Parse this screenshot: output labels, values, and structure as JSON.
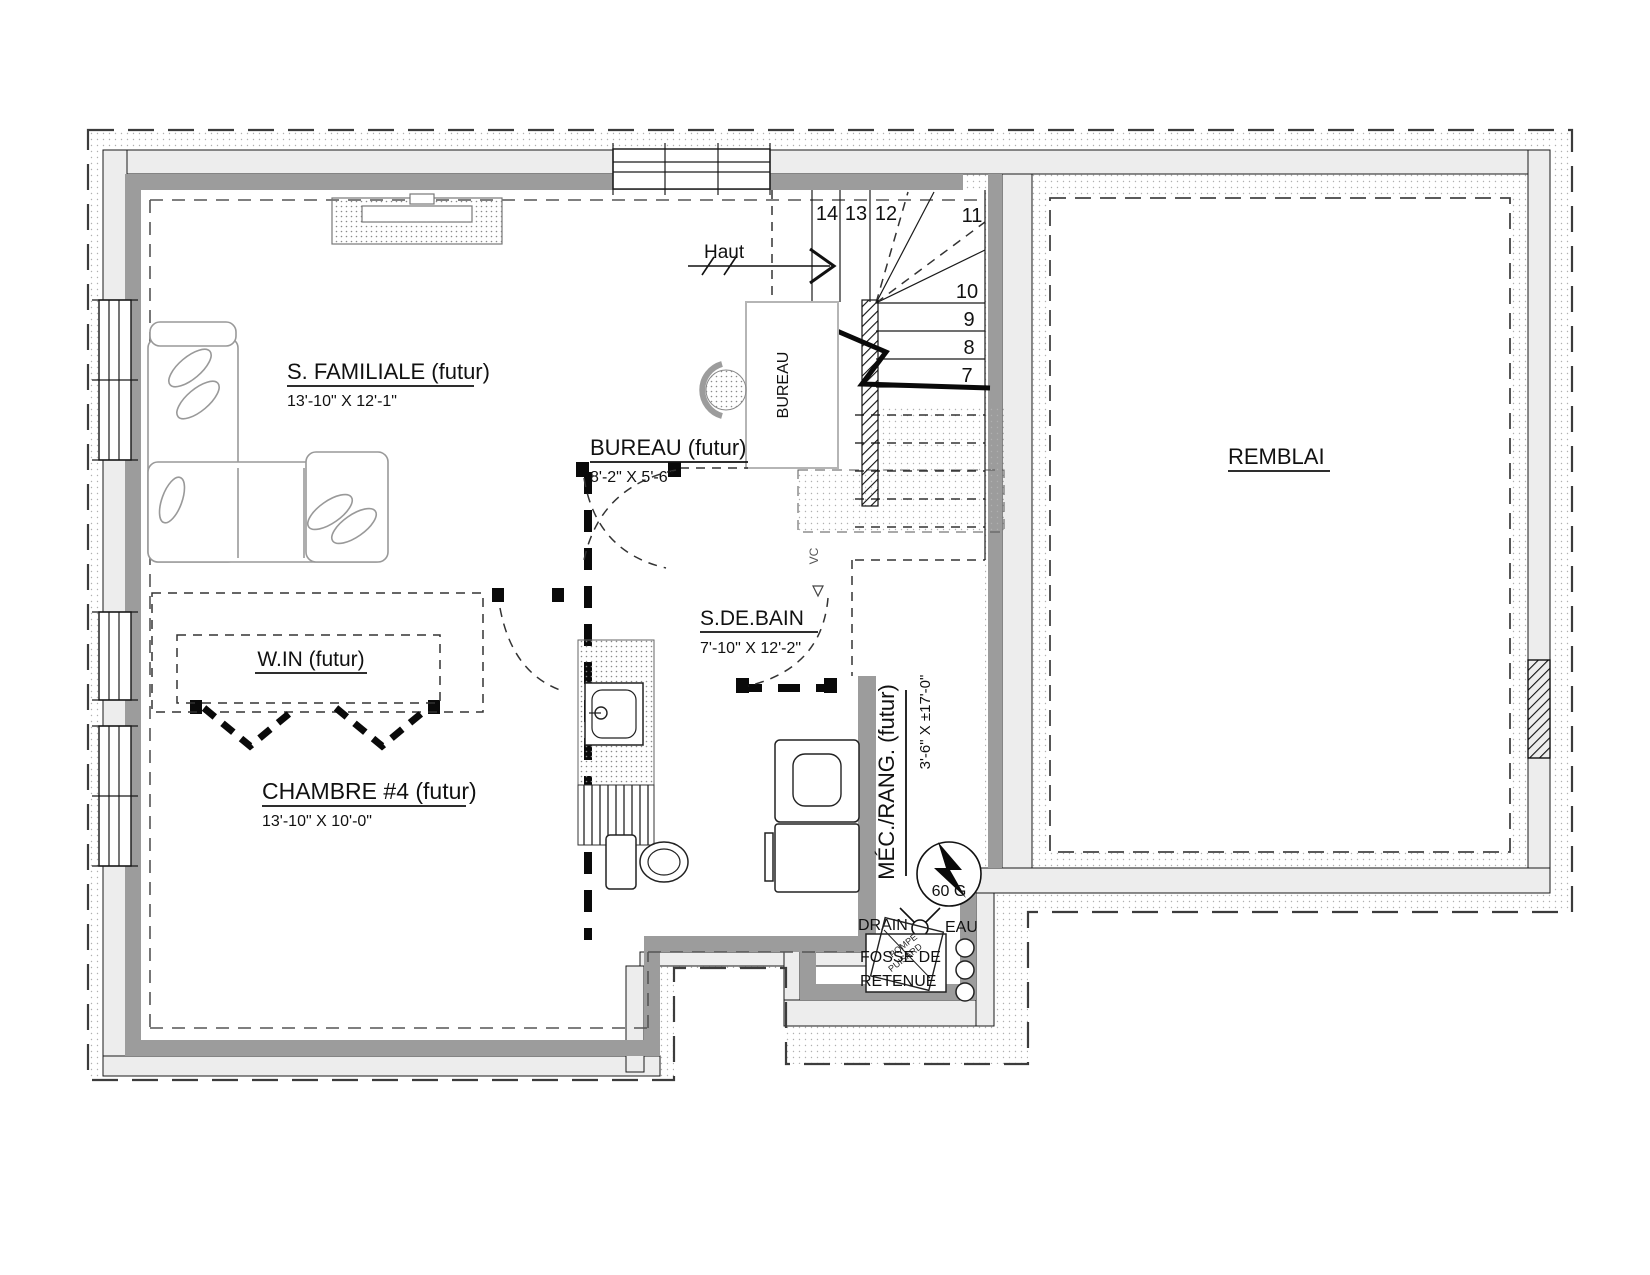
{
  "drawing": {
    "rooms": {
      "familiale": {
        "name": "S. FAMILIALE (futur)",
        "dims": "13'-10\" X 12'-1\""
      },
      "bureau": {
        "name": "BUREAU (futur)",
        "dims": "8'-2\" X 5'-6\""
      },
      "walkin": {
        "name": "W.IN (futur)"
      },
      "chambre": {
        "name": "CHAMBRE #4 (futur)",
        "dims": "13'-10\" X 10'-0\""
      },
      "bain": {
        "name": "S.DE.BAIN",
        "dims": "7'-10\" X 12'-2\""
      },
      "mec": {
        "name": "MÉC./RANG. (futur)",
        "dims": "3'-6\" X ±17'-0\""
      },
      "remblai": {
        "name": "REMBLAI"
      }
    },
    "stairs": {
      "up_label": "Haut",
      "risers": [
        "14",
        "13",
        "12",
        "11",
        "10",
        "9",
        "8",
        "7"
      ]
    },
    "fixtures": {
      "water_heater": "60 G",
      "drain": "DRAIN",
      "water": "EAU",
      "sump_line1": "FOSSE DE",
      "sump_line2": "RETENUE",
      "sump_pump_line1": "POMPE",
      "sump_pump_line2": "PUISARD",
      "desk": "BUREAU",
      "wc": "VC"
    },
    "colors": {
      "wall_concrete": "#ededed",
      "wall_stud": "#9c9c9c",
      "line": "#1a1a1a",
      "light_outline": "#b5b5b5"
    }
  }
}
